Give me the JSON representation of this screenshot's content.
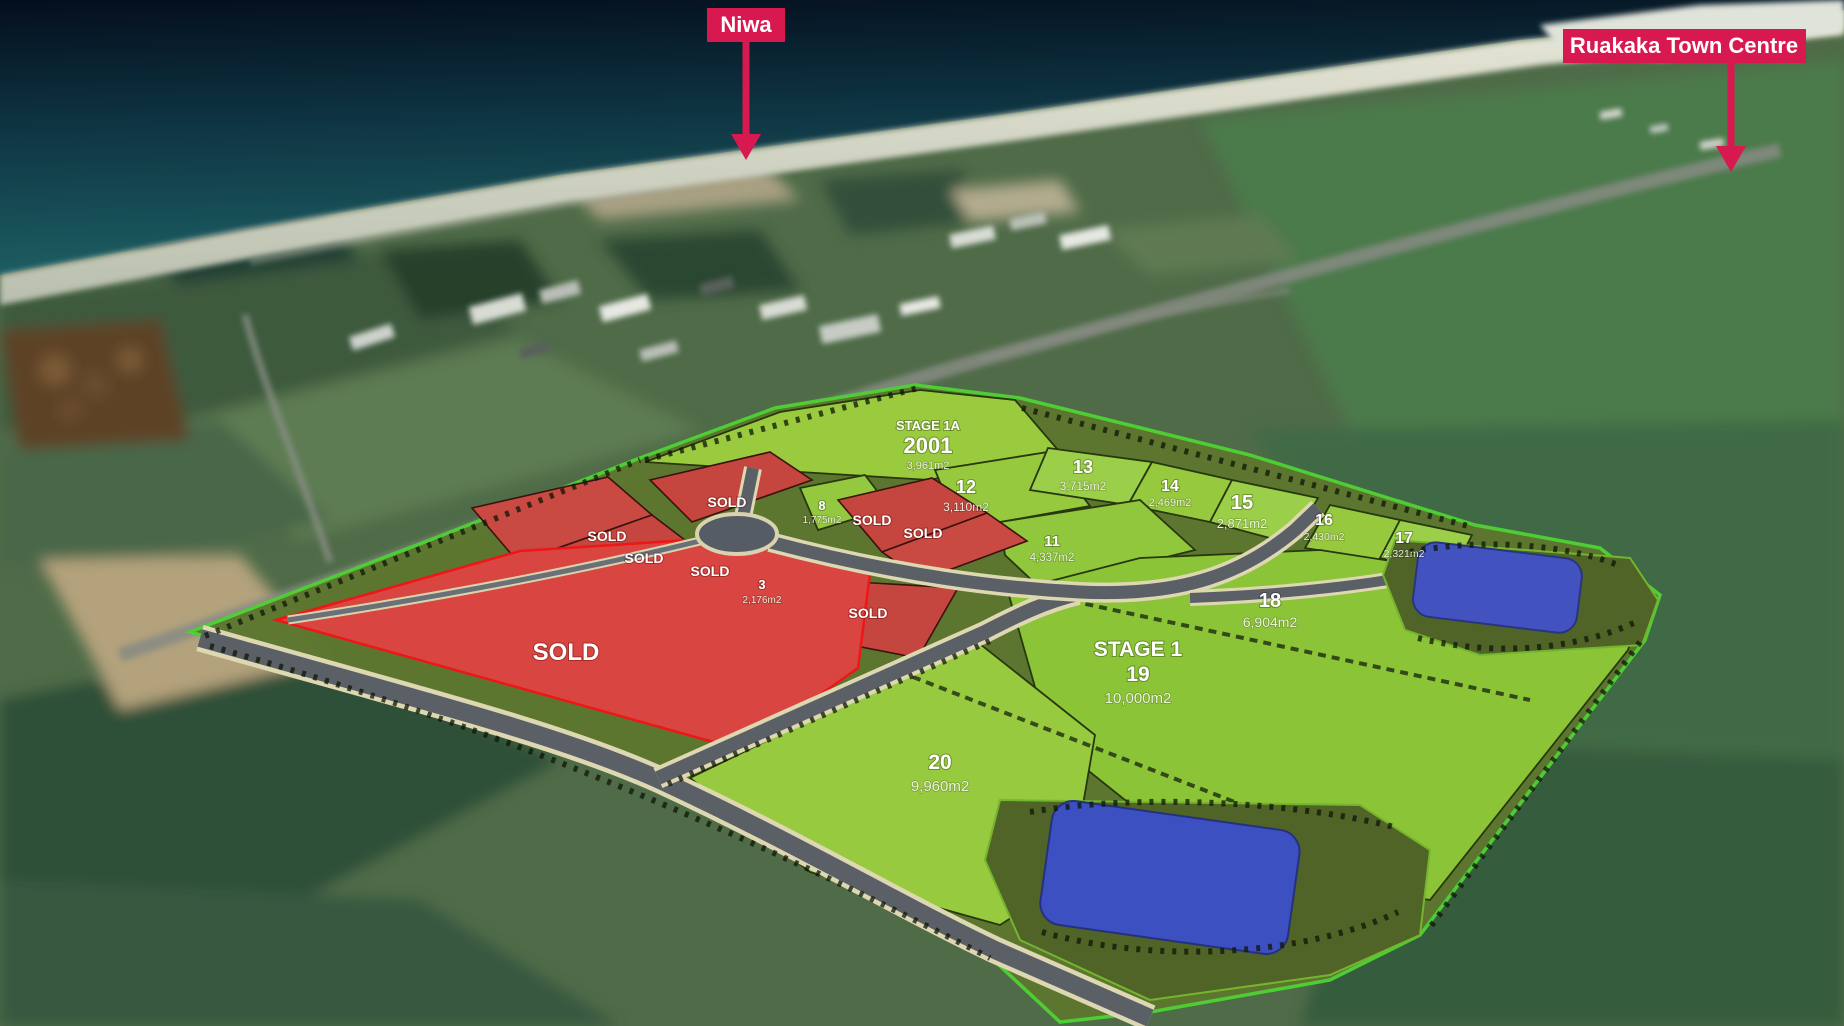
{
  "annotations": {
    "niwa": "Niwa",
    "town_centre": "Ruakaka Town Centre"
  },
  "plan": {
    "sold_label": "SOLD",
    "sold_parcels_count": 8,
    "stage_1a": {
      "title": "STAGE 1A",
      "lot": "2001",
      "area": "3,961m2"
    },
    "stage_1": {
      "title": "STAGE 1",
      "lot": "19",
      "area": "10,000m2"
    },
    "lots": {
      "3": {
        "number": "3",
        "area": "2,176m2"
      },
      "8": {
        "number": "8",
        "area": "1,775m2"
      },
      "11": {
        "number": "11",
        "area": "4,337m2"
      },
      "12": {
        "number": "12",
        "area": "3,110m2"
      },
      "13": {
        "number": "13",
        "area": "3,715m2"
      },
      "14": {
        "number": "14",
        "area": "2,469m2"
      },
      "15": {
        "number": "15",
        "area": "2,871m2"
      },
      "16": {
        "number": "16",
        "area": "2,430m2"
      },
      "17": {
        "number": "17",
        "area": "2,321m2"
      },
      "18": {
        "number": "18",
        "area": "6,904m2"
      },
      "20": {
        "number": "20",
        "area": "9,960m2"
      }
    }
  },
  "colors": {
    "available_green": "#96c93d",
    "sold_red": "#d94540",
    "annotation_pink": "#d81950",
    "pond_blue": "#3c50c2"
  }
}
